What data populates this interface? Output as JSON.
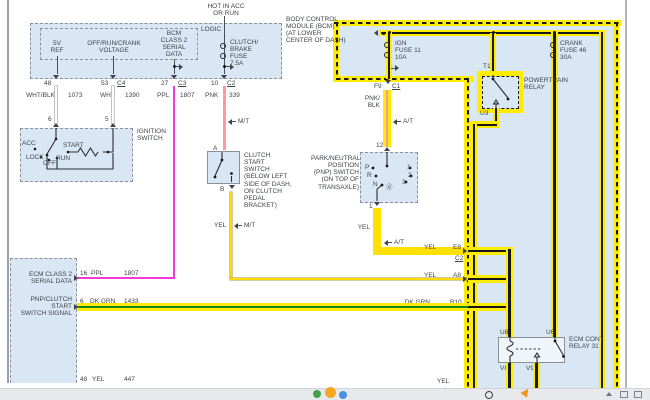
{
  "colors": {
    "highlight": "#ffec00",
    "blue_fill": "#d9e7f5",
    "ppl_wire": "#f23ad6",
    "pnk_wire": "#ff97a0",
    "yel_wire": "#ffd900",
    "dk_grn_wire": "#18861c",
    "wht_wire": "#fbfbfb",
    "black_core": "#17181a"
  },
  "bcm": {
    "hot": "HOT IN ACC\nOR RUN",
    "name": "BODY CONTROL\nMODULE (BCM)\n(AT LOWER\nCENTER OF DASH)",
    "logic": "LOGIC",
    "sig_5v": "5V\nREF",
    "sig_offrun": "OFF/RUN/CRANK\nVOLTAGE",
    "sig_class2": "BCM\nCLASS 2\nSERIAL\nDATA",
    "fuse": "CLUTCH/\nBRAKE\nFUSE\n7.5A",
    "pin48": "48",
    "pin53": "53",
    "conn_c4": "C4",
    "pin27": "27",
    "conn_c3": "C3",
    "pin10": "10",
    "conn_c2": "C2"
  },
  "wires": {
    "whtblk": "WHT/BLK",
    "whtblk_ckt": "1073",
    "wht": "WHT",
    "wht_ckt": "1390",
    "ppl": "PPL",
    "ppl_ckt": "1807",
    "pnk": "PNK",
    "pnk_ckt": "339",
    "pnkblk": "PNK/\nBLK",
    "yel": "YEL",
    "dkgrn": "DK GRN",
    "dkgrn_ckt": "1433",
    "yel_ckt_bottom": "447",
    "mt": "M/T",
    "at": "A/T"
  },
  "ignition": {
    "name": "IGNITION\nSWITCH",
    "pin6": "6",
    "pin5": "5",
    "acc": "ACC",
    "lock": "LOCK",
    "off": "OFF",
    "run": "RUN",
    "start": "START"
  },
  "clutch": {
    "name": "CLUTCH\nSTART\nSWITCH\n(BELOW LEFT\nSIDE OF DASH,\nON CLUTCH\nPEDAL BRACKET)",
    "pinA": "A",
    "pinB": "B"
  },
  "pnp": {
    "name": "PARK/NEUTRAL\nPOSITION\n(PNP) SWITCH\n(ON TOP OF\nTRANSAXLE)",
    "pin12": "12",
    "pin1": "1",
    "p": "P",
    "r": "R",
    "n": "N",
    "d": "ⓓ",
    "g1": "1",
    "g2": "2",
    "g3": "3"
  },
  "fuseblock": {
    "ign_fuse": "IGN\nFUSE 11\n10A",
    "crank_fuse": "CRANK\nFUSE 46\n30A",
    "pinF9": "F9",
    "connC1": "C1",
    "pinE8": "E8",
    "connE8": "C2",
    "pinA8": "A8",
    "pinB10": "B10"
  },
  "pt_relay": {
    "name": "POWERTRAIN\nRELAY",
    "t1": "T1",
    "u3": "U3"
  },
  "ecm_relay": {
    "name": "ECM CONT\nRELAY 31",
    "u8": "U8",
    "u6": "U6",
    "v8": "V8",
    "v9": "V9"
  },
  "ecm": {
    "sig1": "ECM CLASS 2\nSERIAL DATA",
    "sig2": "PNP/CLUTCH START\nSWITCH SIGNAL",
    "pin16": "16",
    "pin6": "6",
    "pin48": "48"
  }
}
